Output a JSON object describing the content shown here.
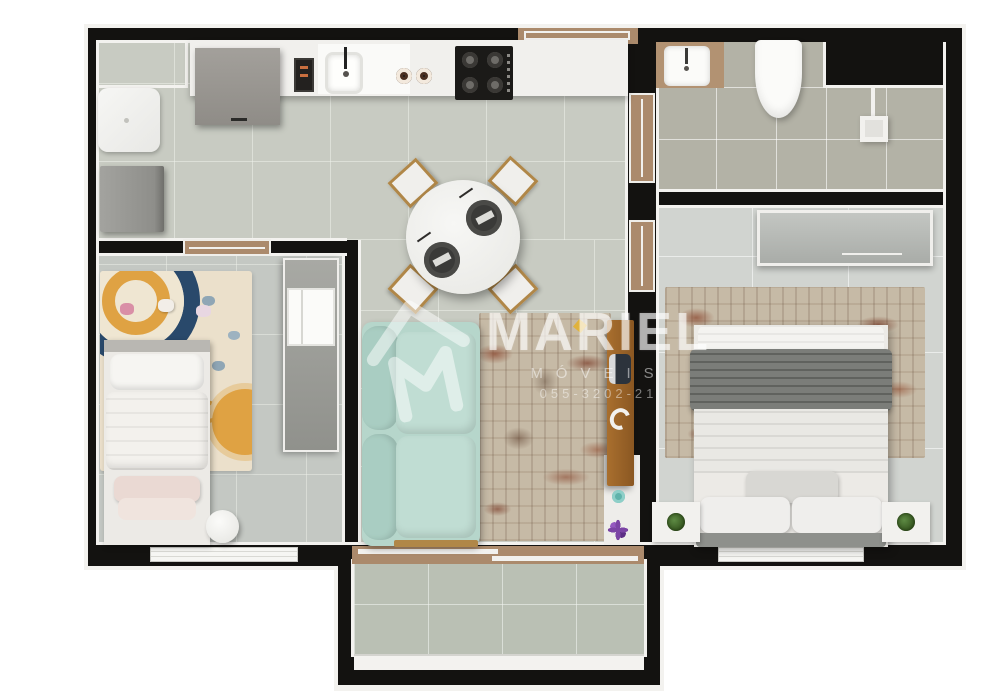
{
  "scene": {
    "type": "apartment-floor-plan-3d-top-view",
    "rooms": [
      "kitchen-laundry",
      "dining-area",
      "living-room",
      "kids-bedroom",
      "bathroom",
      "master-bedroom",
      "balcony"
    ]
  },
  "watermark": {
    "brand": "MARIEL",
    "line2": "MÓVEIS",
    "line3": "055-3202-21",
    "icon": "house-m-logo"
  },
  "palette": {
    "wall": "#131210",
    "trim": "#f3f2ef",
    "floorMain": "#c8cbc2",
    "floorKids": "#c4c8c3",
    "floorBed": "#d1d4d0",
    "floorBath": "#b3b2a6",
    "floorBalc": "#bac0b4",
    "counter": "#f1f0ed",
    "applianceGray": "#9d9a95",
    "stoveBlack": "#1b1a18",
    "doorWood": "#ab8a6c",
    "consoleWood": "#96622a",
    "sofaMint": "#b6d6cb",
    "rugBase": "#c6baa6",
    "rugRust": "#8c4a32",
    "bedBlanketGray": "#7b7d79",
    "kidsRugCream": "#ebe0cb",
    "kidsOrange": "#dfa243",
    "kidsNavy": "#29496b",
    "plantGreen": "#41682f",
    "accentPurple": "#7b44a5",
    "accentTeal": "#5fb3ab"
  }
}
